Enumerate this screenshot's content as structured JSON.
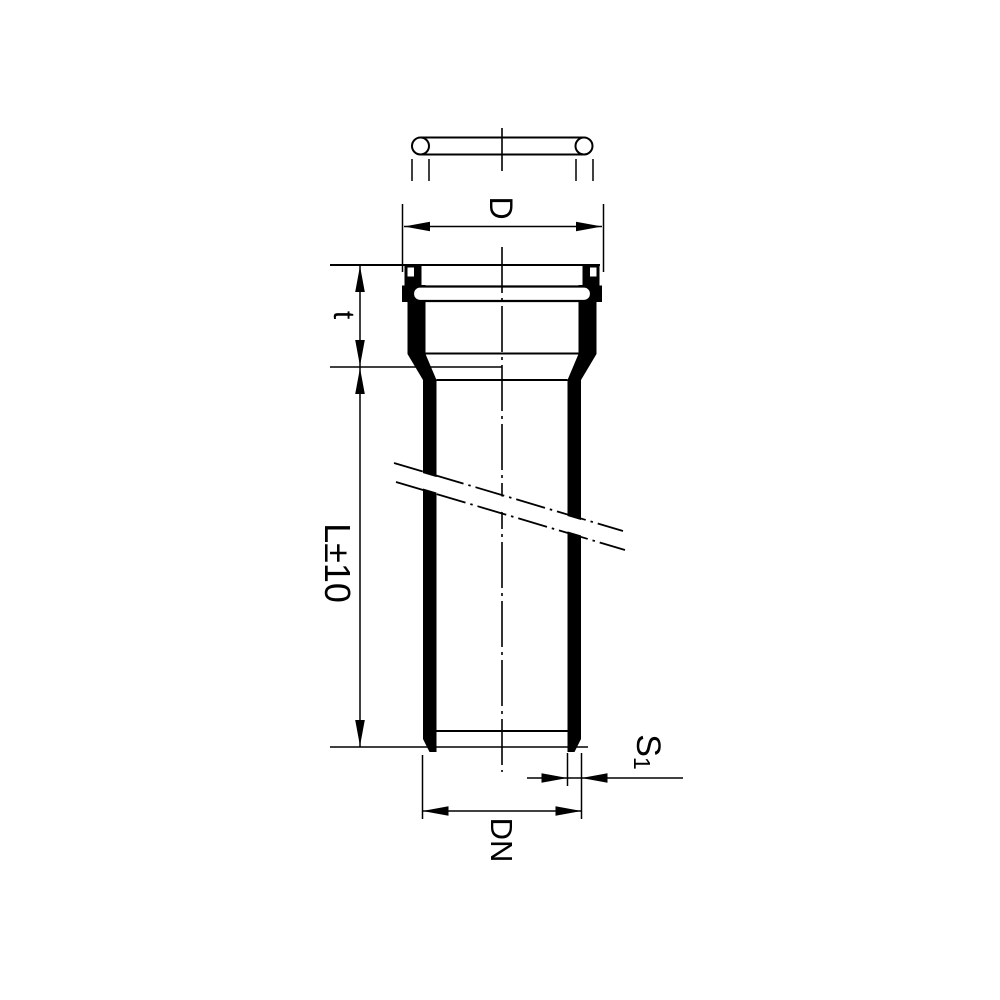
{
  "colors": {
    "ink": "#000000",
    "paper": "#ffffff"
  },
  "labels": {
    "socket_outer_diameter": "D",
    "socket_depth": "t",
    "pipe_length": "L±10",
    "wall_thickness_symbol": "S",
    "wall_thickness_subscript": "1",
    "nominal_diameter": "DN"
  }
}
